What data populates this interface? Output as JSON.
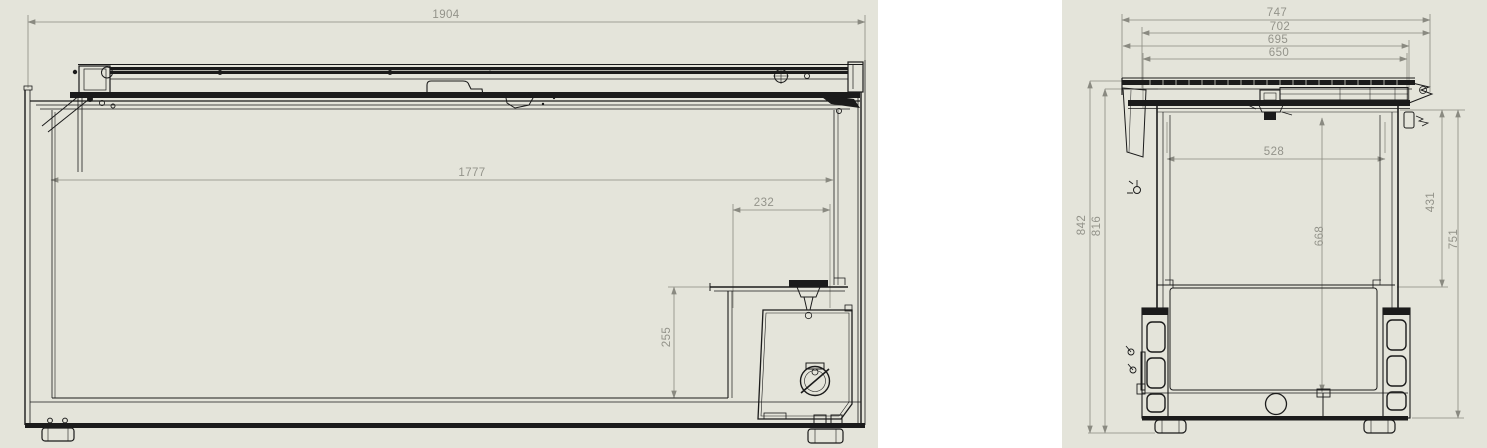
{
  "sheet": {
    "background": "#e4e4da",
    "divider": "#ffffff",
    "ink": "#1b1b1b",
    "dim_ink": "#8a8a81"
  },
  "front_view": {
    "dims": {
      "overall_width": "1904",
      "interior_width": "1777",
      "step_width": "232",
      "step_height": "255"
    }
  },
  "side_view": {
    "dims": {
      "overall_depth": "747",
      "lid_outer_depth": "702",
      "lid_depth": "695",
      "body_depth": "650",
      "overall_height": "842",
      "case_height": "816",
      "opening_depth": "528",
      "interior_depth": "668",
      "upper_interior_height": "431",
      "interior_front_height": "751"
    }
  }
}
